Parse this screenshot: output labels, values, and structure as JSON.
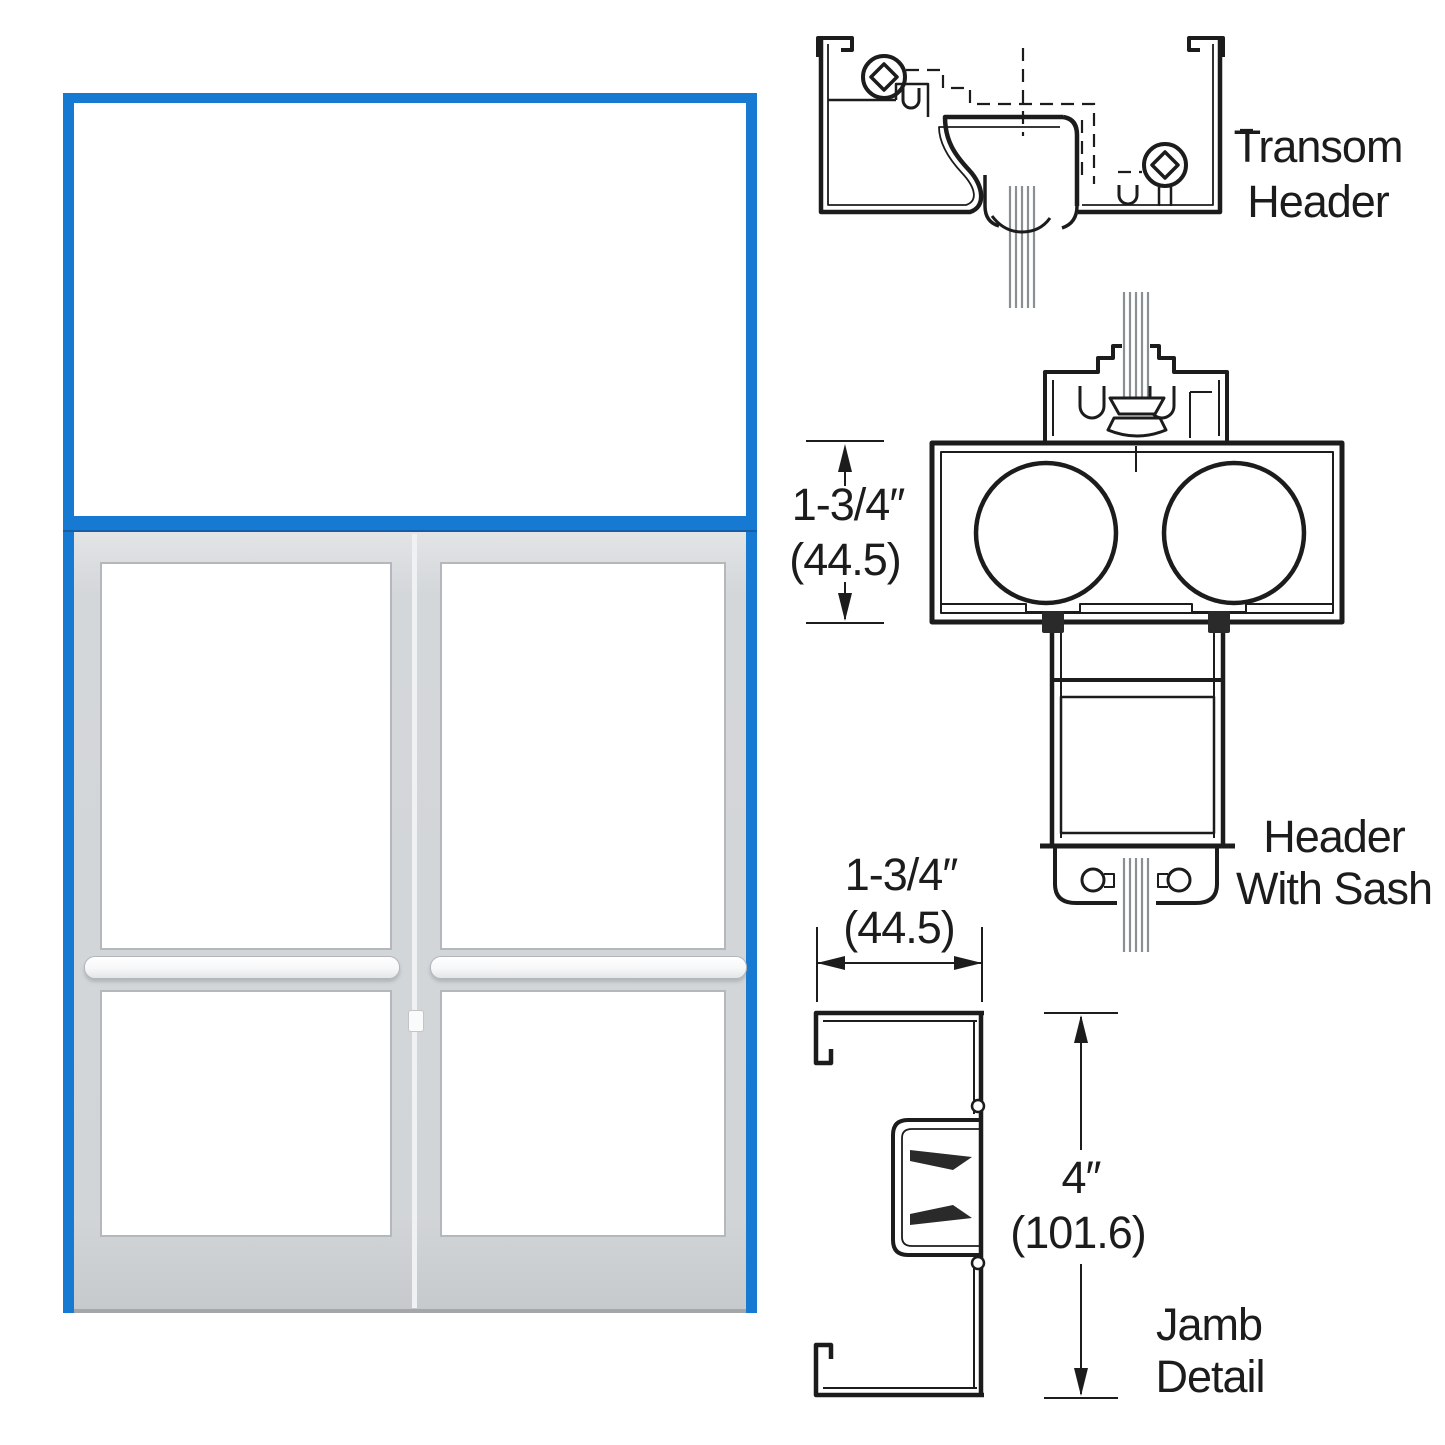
{
  "figure": {
    "type": "storefront-door-technical-diagram",
    "details": [
      {
        "id": "transom-header",
        "label_lines": [
          "Transom",
          "Header"
        ]
      },
      {
        "id": "header-with-sash",
        "label_lines": [
          "Header",
          "With Sash"
        ],
        "dimension": {
          "primary": "1-3/4″",
          "metric": "(44.5)"
        }
      },
      {
        "id": "jamb-detail",
        "label_lines": [
          "Jamb",
          "Detail"
        ],
        "dimensions": [
          {
            "primary": "1-3/4″",
            "metric": "(44.5)"
          },
          {
            "primary": "4″",
            "metric": "(101.6)"
          }
        ]
      }
    ],
    "colors": {
      "frame_blue": "#177ad2",
      "door_gray": "#d2d5d8",
      "line": "#1c1c1c",
      "glass_hatch": "#8a8f94"
    }
  }
}
